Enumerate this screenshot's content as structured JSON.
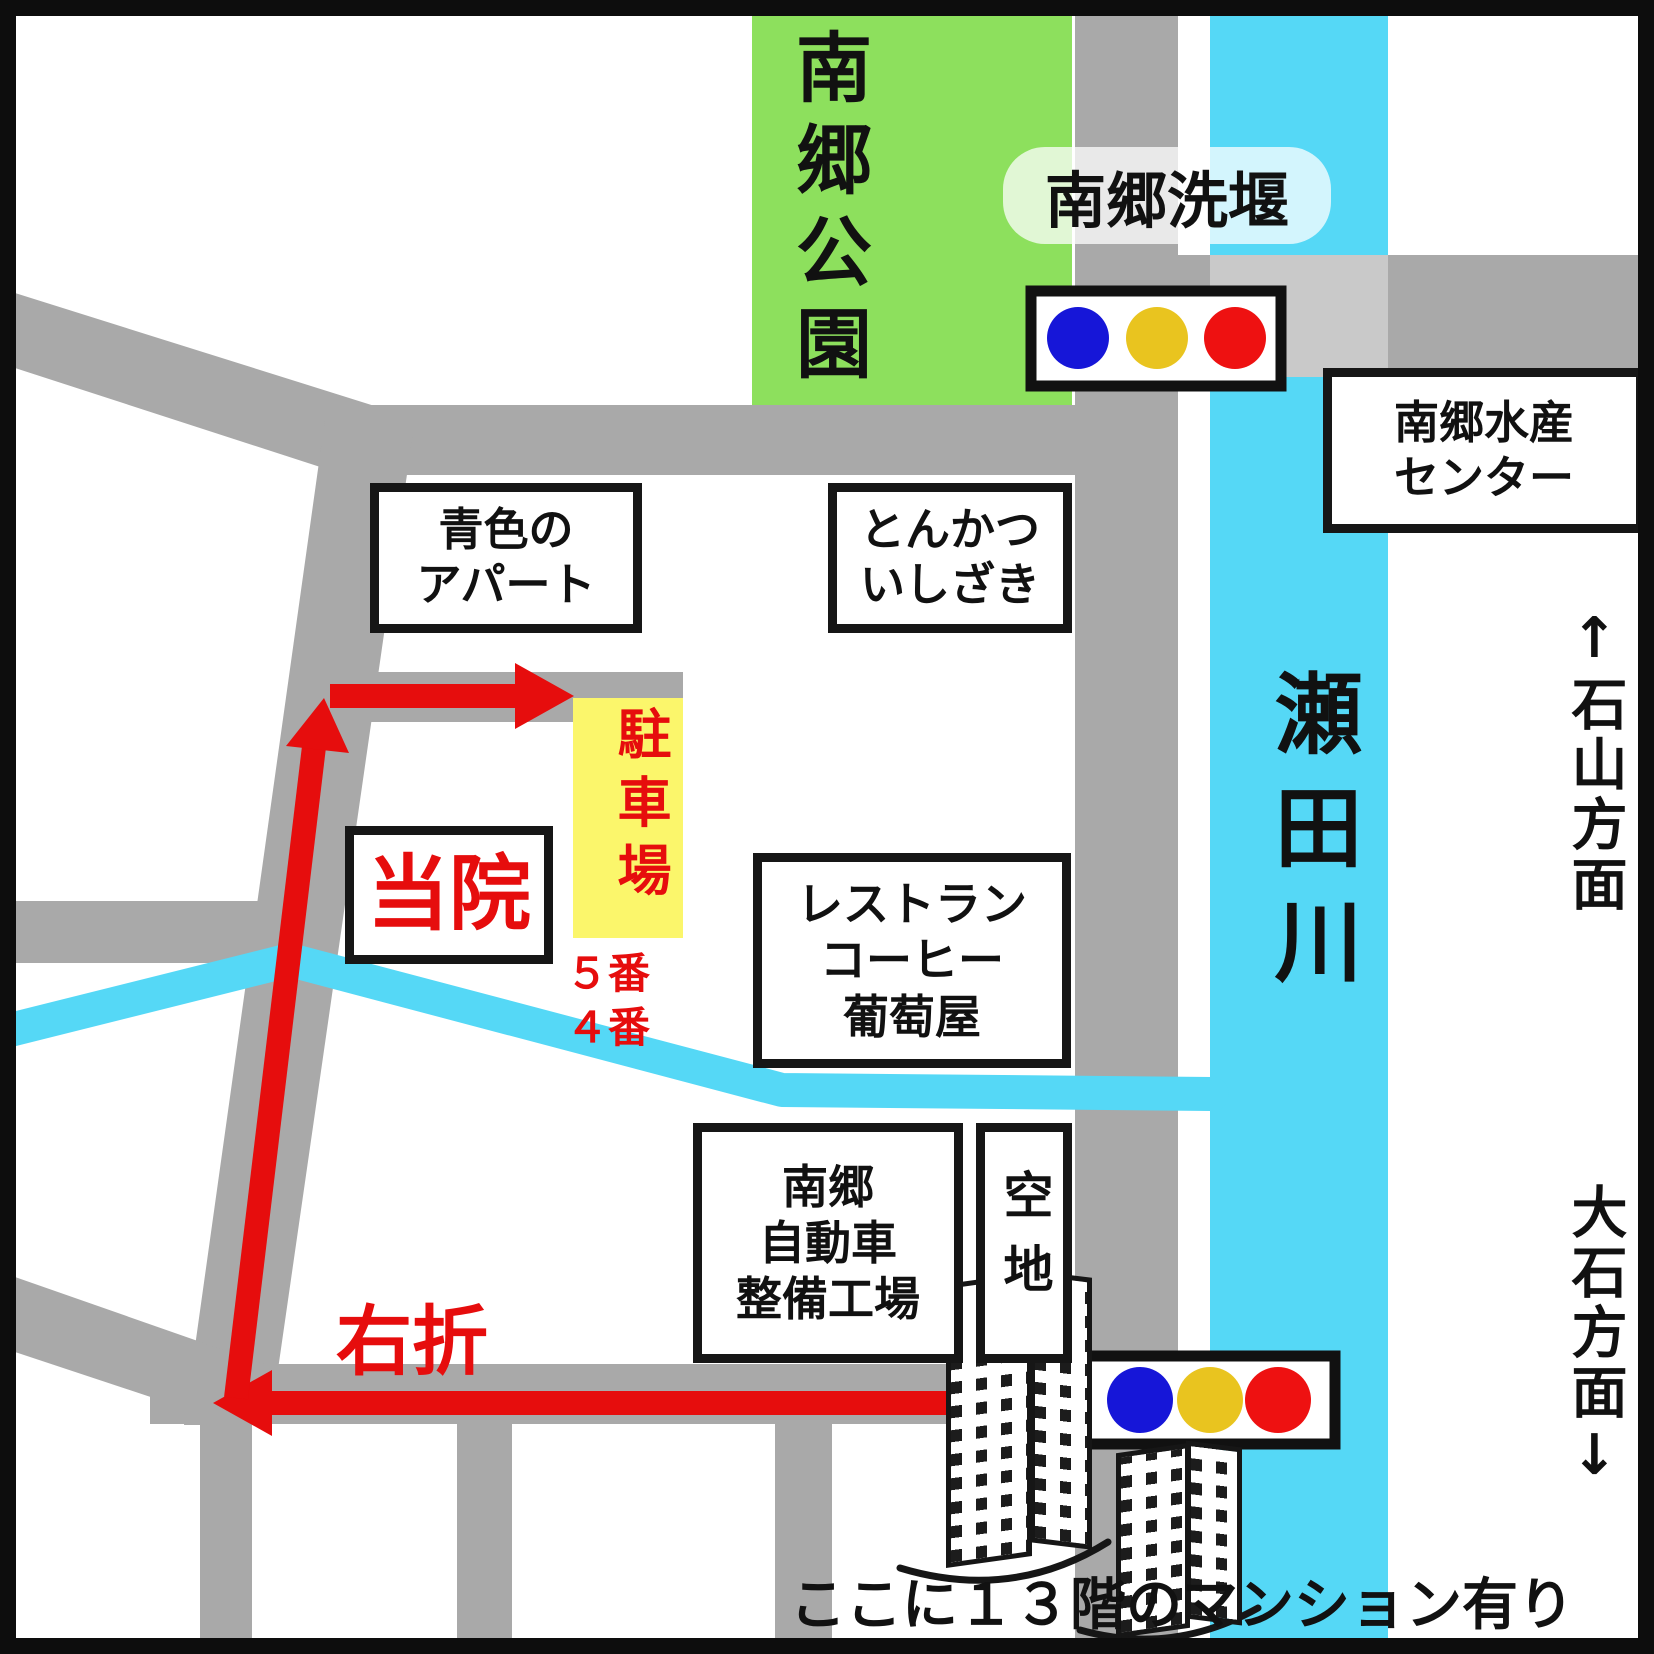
{
  "colors": {
    "road_gray": "#a9a9a9",
    "bridge_gray": "#c9c9c9",
    "river_cyan": "#55d8f6",
    "park_green": "#8de05d",
    "parking_yellow": "#fbf66b",
    "route_red": "#e60d0d",
    "signal_blue": "#1616d8",
    "signal_yellow": "#e9c41f",
    "signal_red": "#ee1111"
  },
  "park": {
    "name": "南郷公園"
  },
  "river": {
    "name": "瀬田川"
  },
  "weir": {
    "label": "南郷洗堰"
  },
  "fisheries": {
    "line1": "南郷水産",
    "line2": "センター"
  },
  "directions": {
    "ishiyama": "↑石山方面",
    "oishi": "大石方面↓"
  },
  "apartment": {
    "line1": "青色の",
    "line2": "アパート"
  },
  "tonkatsu": {
    "line1": "とんかつ",
    "line2": "いしざき"
  },
  "clinic": {
    "label": "当院"
  },
  "parking": {
    "label": "駐車場",
    "slot1": "５番",
    "slot2": "４番"
  },
  "restaurant": {
    "line1": "レストラン",
    "line2": "コーヒー",
    "line3": "葡萄屋"
  },
  "garage": {
    "line1": "南郷",
    "line2": "自動車",
    "line3": "整備工場"
  },
  "vacant": {
    "label": "空地"
  },
  "route": {
    "turn_right": "右折"
  },
  "note": {
    "mansion": "ここに１３階のマンション有り"
  }
}
